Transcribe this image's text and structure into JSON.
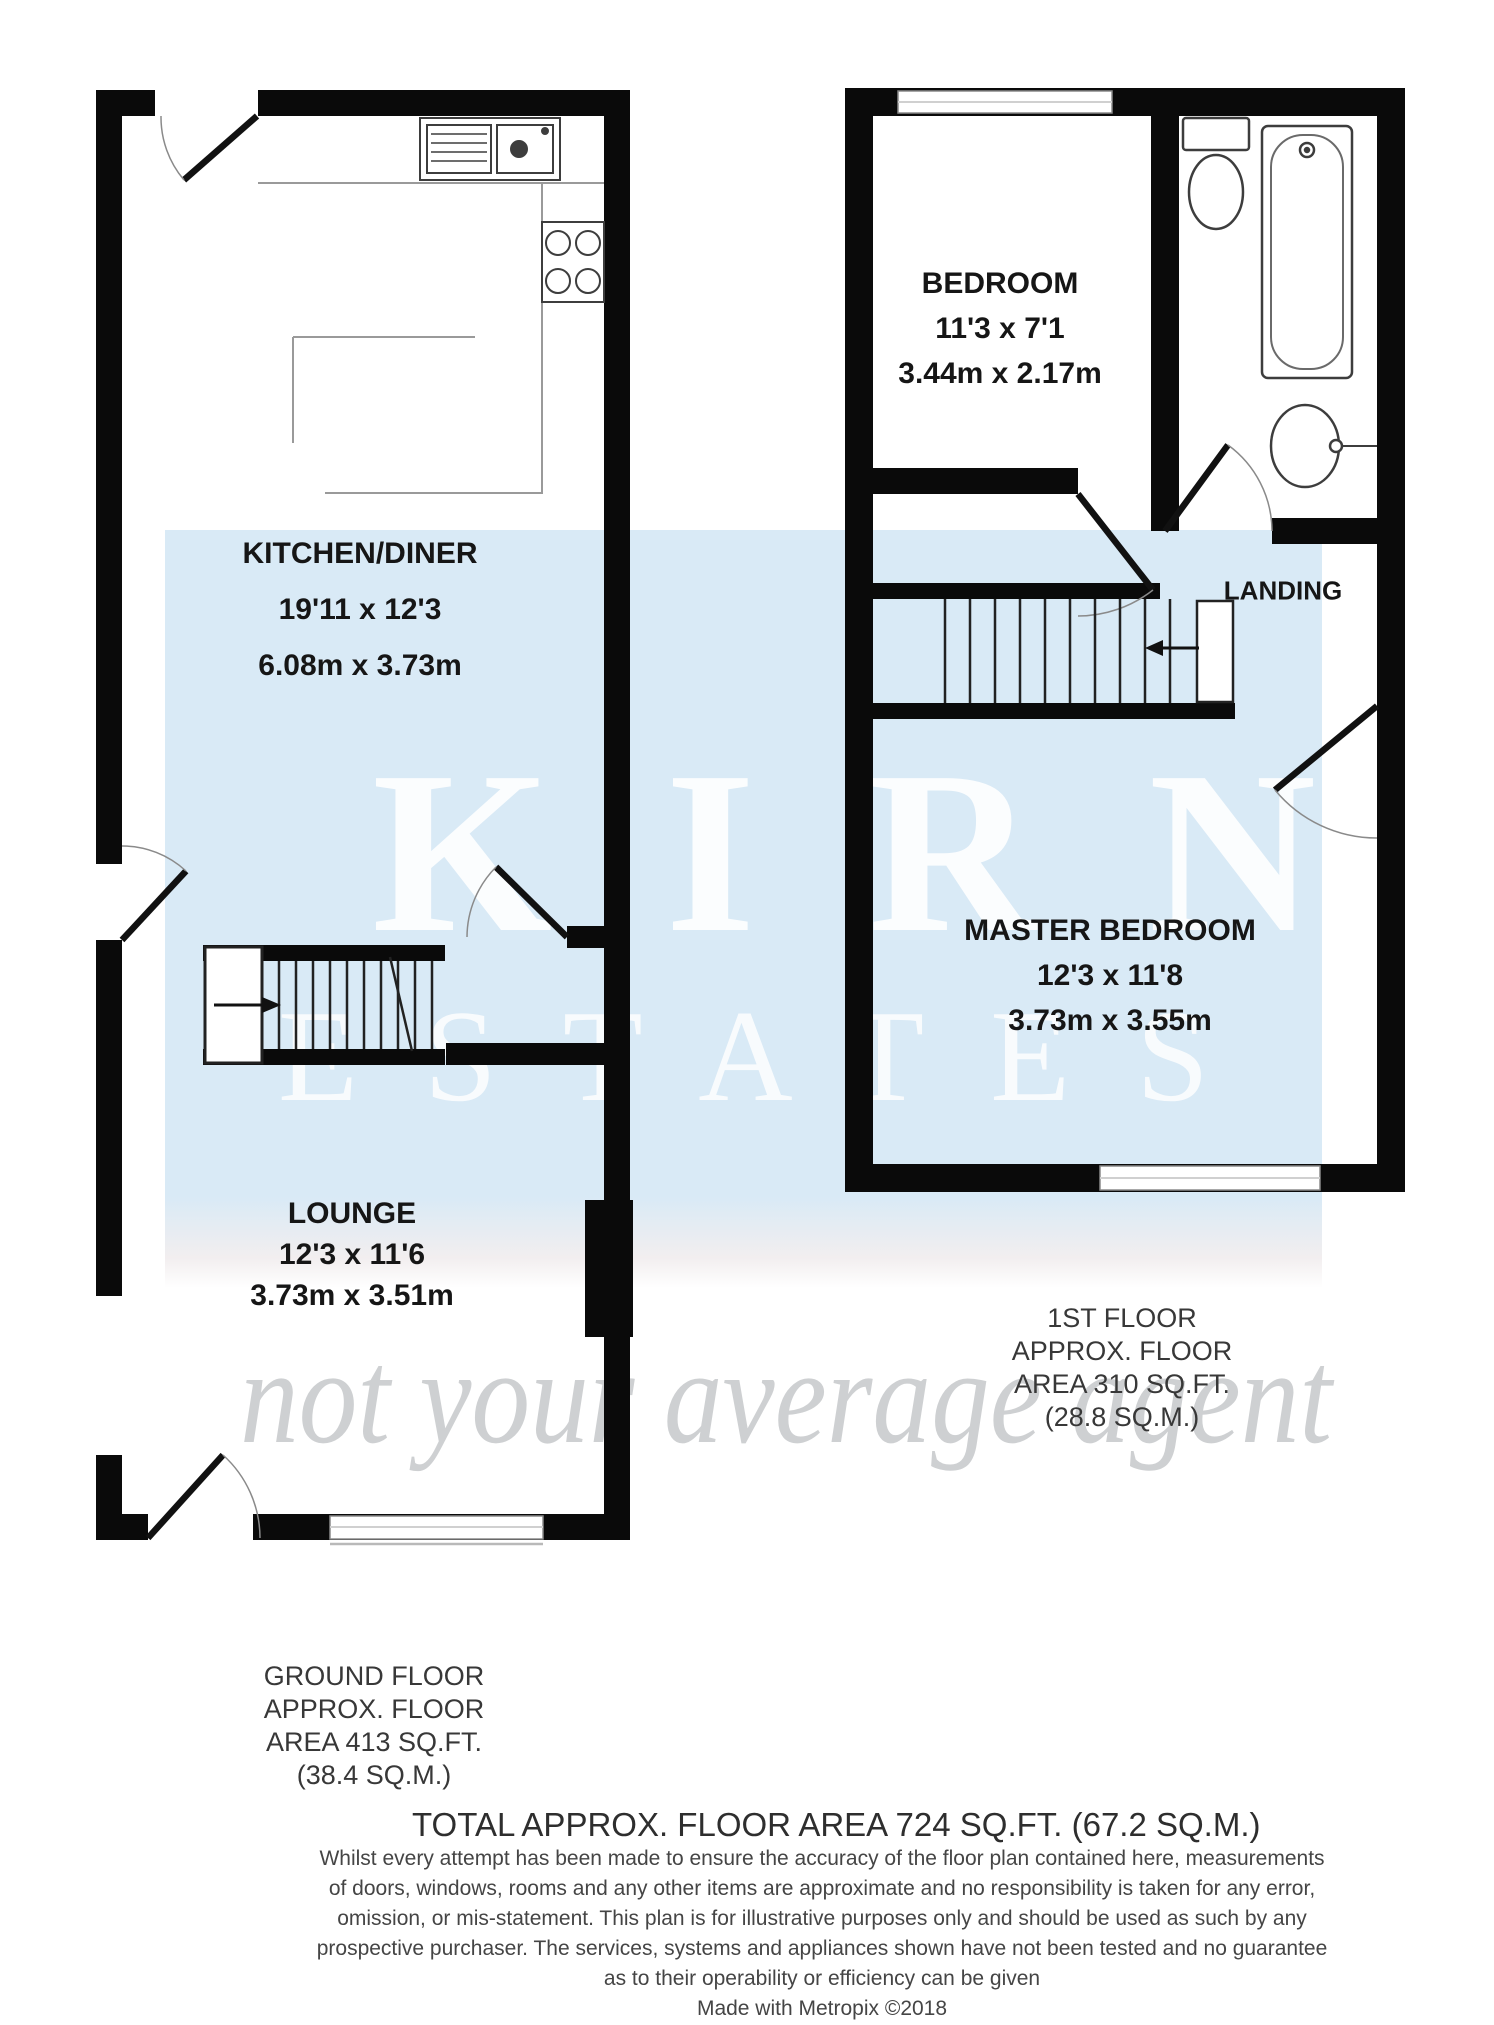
{
  "watermark": {
    "brand": "KIRN",
    "brand_sub": "ESTATES",
    "tagline": "not your average agent",
    "box_color": "#d9eaf6",
    "letter_color": "#ffffff"
  },
  "ground_floor": {
    "kitchen_diner": {
      "name": "KITCHEN/DINER",
      "size_imperial": "19'11 x 12'3",
      "size_metric": "6.08m x 3.73m"
    },
    "lounge": {
      "name": "LOUNGE",
      "size_imperial": "12'3 x 11'6",
      "size_metric": "3.73m x 3.51m"
    },
    "area_lines": [
      "GROUND FLOOR",
      "APPROX. FLOOR",
      "AREA 413 SQ.FT.",
      "(38.4 SQ.M.)"
    ]
  },
  "first_floor": {
    "bedroom": {
      "name": "BEDROOM",
      "size_imperial": "11'3 x 7'1",
      "size_metric": "3.44m x 2.17m"
    },
    "master_bedroom": {
      "name": "MASTER BEDROOM",
      "size_imperial": "12'3 x 11'8",
      "size_metric": "3.73m x 3.55m"
    },
    "landing": {
      "name": "LANDING"
    },
    "area_lines": [
      "1ST FLOOR",
      "APPROX. FLOOR",
      "AREA 310 SQ.FT.",
      "(28.8 SQ.M.)"
    ]
  },
  "footer": {
    "total_area": "TOTAL APPROX. FLOOR AREA 724 SQ.FT. (67.2 SQ.M.)",
    "disclaimer_lines": [
      "Whilst every attempt has been made to ensure the accuracy of the floor plan contained here, measurements",
      "of doors, windows, rooms and any other items are approximate and no responsibility is taken for any error,",
      "omission, or mis-statement. This plan is for illustrative purposes only and should be used as such by any",
      "prospective purchaser. The services, systems and appliances shown have not been tested and no guarantee",
      "as to their operability or efficiency can be given"
    ],
    "credit": "Made with Metropix ©2018"
  }
}
